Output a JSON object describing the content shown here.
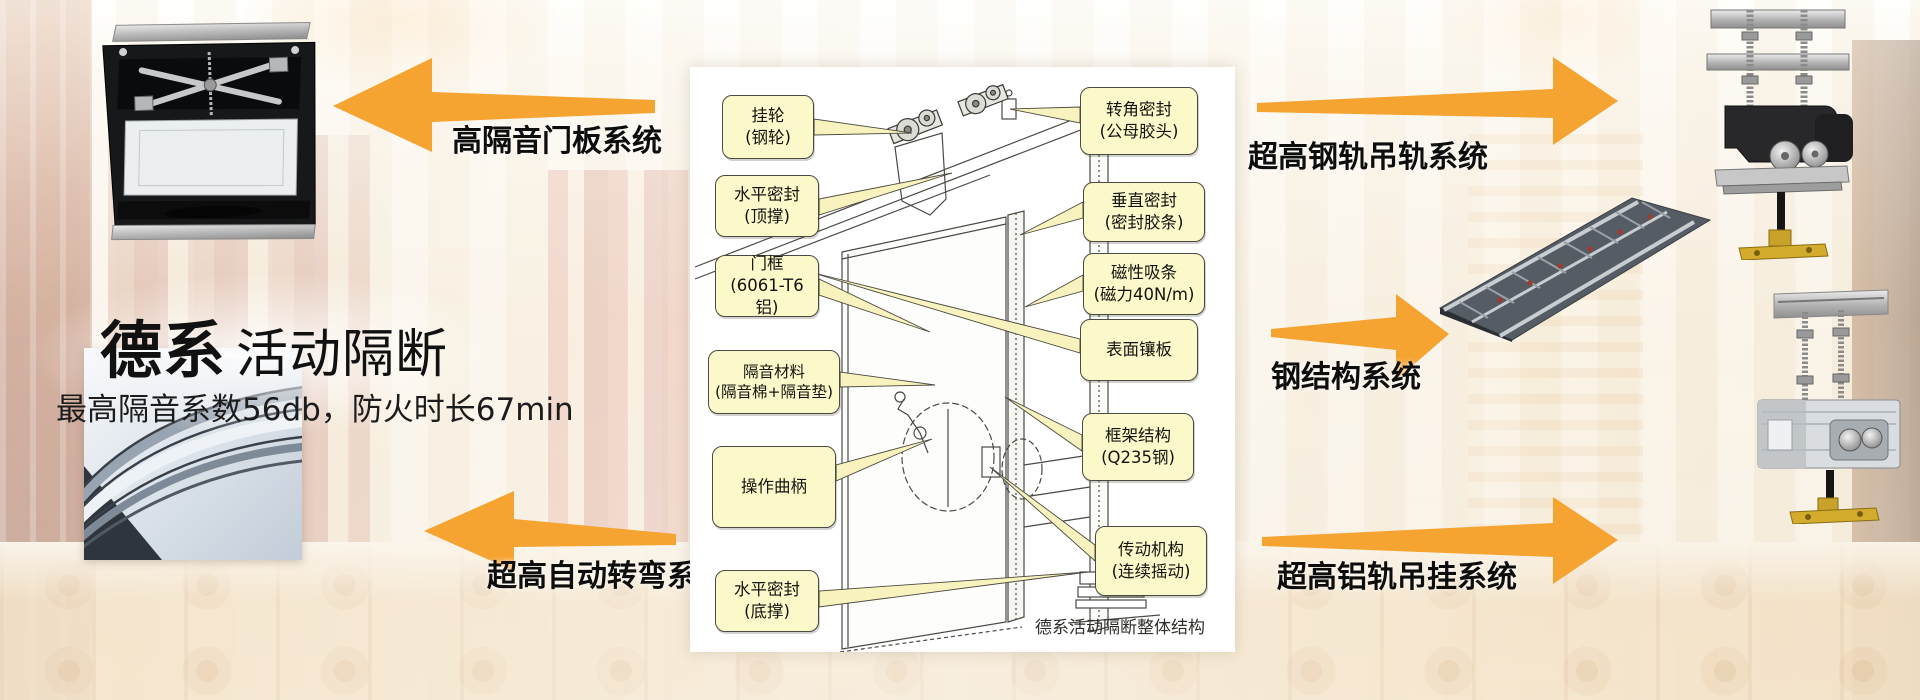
{
  "brand": {
    "title_bold": "德系",
    "title_regular": "活动隔断",
    "subtitle": "最高隔音系数56db，防火时长67min"
  },
  "systems": {
    "door_panel": "高隔音门板系统",
    "auto_turn": "超高自动转弯系统",
    "steel_rail": "超高钢轨吊轨系统",
    "steel_structure": "钢结构系统",
    "alu_rail": "超高铝轨吊挂系统"
  },
  "diagram": {
    "caption": "德系活动隔断整体结构",
    "left_labels": [
      {
        "line1": "挂轮",
        "line2": "(钢轮)"
      },
      {
        "line1": "水平密封",
        "line2": "(顶撑)"
      },
      {
        "line1": "门框",
        "line2": "(6061-T6铝)"
      },
      {
        "line1": "隔音材料",
        "line2": "(隔音棉+隔音垫)"
      },
      {
        "line1": "操作曲柄"
      },
      {
        "line1": "水平密封",
        "line2": "(底撑)"
      }
    ],
    "right_labels": [
      {
        "line1": "转角密封",
        "line2": "(公母胶头)"
      },
      {
        "line1": "垂直密封",
        "line2": "(密封胶条)"
      },
      {
        "line1": "磁性吸条",
        "line2": "(磁力40N/m)"
      },
      {
        "line1": "表面镶板"
      },
      {
        "line1": "框架结构",
        "line2": "(Q235钢)"
      },
      {
        "line1": "传动机构",
        "line2": "(连续摇动)"
      }
    ]
  },
  "colors": {
    "arrow": "#F5A331",
    "callout_bg": "#FBF8CA",
    "callout_border": "#4B4A40",
    "panel_bg": "#FFFFFF"
  }
}
